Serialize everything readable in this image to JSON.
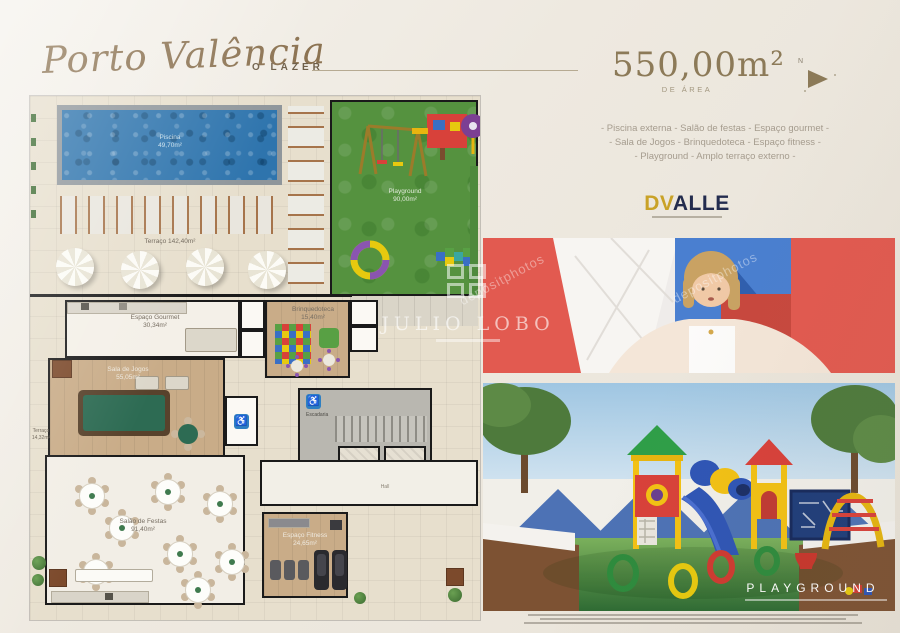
{
  "colors": {
    "gold": "#8c7a58",
    "navy": "#232c4e",
    "logo_gold": "#c9a227",
    "pool_blue": "#2e74ad",
    "lawn_green": "#55923f",
    "photo_red": "#e25a50"
  },
  "header": {
    "brand": "Porto Valência",
    "section": "O LAZER",
    "area_value": "550,00m²",
    "area_caption": "DE ÁREA",
    "compass_n": "N"
  },
  "amenities": [
    "- Piscina externa - Salão de festas - Espaço gourmet -",
    "- Sala de Jogos - Brinquedoteca - Espaço fitness -",
    "- Playground - Amplo terraço externo -"
  ],
  "developer": {
    "dv": "DV",
    "alle": "ALLE"
  },
  "floorplan": {
    "piscina": {
      "name": "Piscina",
      "area": "49,70m²"
    },
    "terraco": {
      "name": "Terraço",
      "area": "142,40m²"
    },
    "playground": {
      "name": "Playground",
      "area": "90,00m²"
    },
    "gourmet": {
      "name": "Espaço Gourmet",
      "area": "30,34m²"
    },
    "brinquedoteca": {
      "name": "Brinquedoteca",
      "area": "15,40m²"
    },
    "jogos": {
      "name": "Sala de Jogos",
      "area": "55,05m²"
    },
    "terraco_lateral": {
      "name": "Terraço",
      "area": "14,32m²"
    },
    "festas": {
      "name": "Salão de Festas",
      "area": "91,40m²"
    },
    "fitness": {
      "name": "Espaço Fitness",
      "area": "24,65m²"
    },
    "escadaria": "Escadaria",
    "hall": "Hall"
  },
  "photos": {
    "playground_caption": "PLAYGROUND"
  },
  "watermarks": {
    "agency": "JULIO LOBO",
    "stock": "depositphotos"
  }
}
